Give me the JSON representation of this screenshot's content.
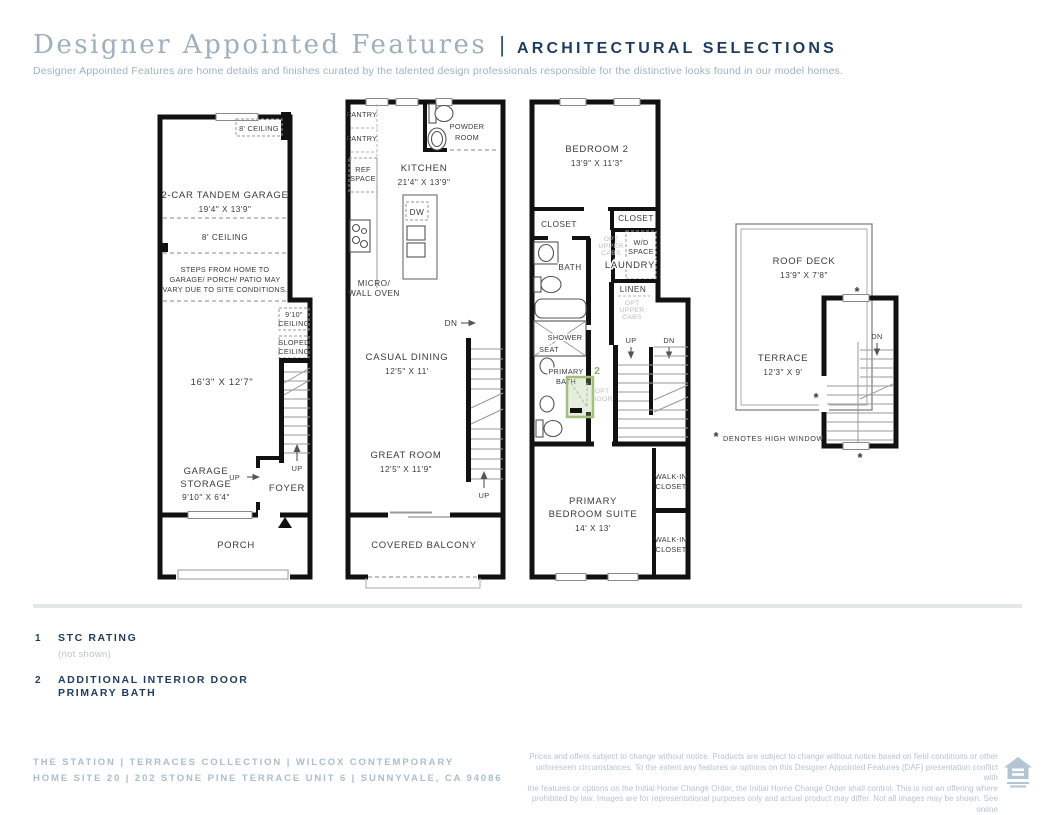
{
  "header": {
    "title_serif": "Designer Appointed Features",
    "divider": "|",
    "title_caps": "ARCHITECTURAL SELECTIONS",
    "subtitle": "Designer Appointed Features are home details and finishes curated by the talented design professionals responsible for the distinctive looks found in our model homes."
  },
  "floor1": {
    "ceiling_note_top": "8' CEILING",
    "garage_name": "2-CAR TANDEM GARAGE",
    "garage_dims": "19'4\" X 13'9\"",
    "ceiling_note_mid": "8' CEILING",
    "steps_note_1": "STEPS FROM HOME TO",
    "steps_note_2": "GARAGE/ PORCH/ PATIO MAY",
    "steps_note_3": "VARY DUE TO SITE CONDITIONS.",
    "ceiling_910_1": "9'10\"",
    "ceiling_910_2": "CEILING",
    "sloped_1": "SLOPED",
    "sloped_2": "CEILING",
    "room_dims": "16'3\" X 12'7\"",
    "storage_1": "GARAGE",
    "storage_2": "STORAGE",
    "storage_dims": "9'10\" X 6'4\"",
    "up_stairs": "UP",
    "up_foyer": "UP",
    "foyer": "FOYER",
    "porch": "PORCH"
  },
  "floor2": {
    "pantry_1": "PANTRY",
    "pantry_2": "PANTRY",
    "ref_1": "REF",
    "ref_2": "SPACE",
    "kitchen": "KITCHEN",
    "kitchen_dims": "21'4\" X 13'9\"",
    "powder_1": "POWDER",
    "powder_2": "ROOM",
    "dw": "DW",
    "micro_1": "MICRO/",
    "micro_2": "WALL OVEN",
    "dn": "DN",
    "casual": "CASUAL DINING",
    "casual_dims": "12'5\" X 11'",
    "great": "GREAT ROOM",
    "great_dims": "12'5\" X 11'9\"",
    "up": "UP",
    "balcony": "COVERED BALCONY"
  },
  "floor3": {
    "bedroom": "BEDROOM 2",
    "bedroom_dims": "13'9\" X 11'3\"",
    "closet_left": "CLOSET",
    "closet_right": "CLOSET",
    "opt_cabs_top": [
      "OPT",
      "UPPER",
      "CABS"
    ],
    "wd_1": "W/D",
    "wd_2": "SPACE",
    "laundry": "LAUNDRY",
    "linen": "LINEN",
    "opt_cabs_bottom": [
      "OPT",
      "UPPER",
      "CABS"
    ],
    "bath": "BATH",
    "shower": "SHOWER",
    "seat": "SEAT",
    "primary_1": "PRIMARY",
    "primary_2": "BATH",
    "callout_2": "2",
    "opt_door_1": "OPT",
    "opt_door_2": "DOOR",
    "up": "UP",
    "dn": "DN",
    "walkin_a1": "WALK-IN",
    "walkin_a2": "CLOSET",
    "walkin_b1": "WALK-IN",
    "walkin_b2": "CLOSET",
    "suite_1": "PRIMARY",
    "suite_2": "BEDROOM SUITE",
    "suite_dims": "14' X 13'"
  },
  "floor4": {
    "roof_deck": "ROOF DECK",
    "roof_dims": "13'9\" X 7'8\"",
    "terrace": "TERRACE",
    "terrace_dims": "12'3\" X 9'",
    "dn": "DN",
    "star": "*",
    "note_star": "*",
    "high_window_note": "DENOTES HIGH WINDOW"
  },
  "legend": {
    "items": [
      {
        "num": "1",
        "label": "STC RATING",
        "sub": "(not shown)"
      },
      {
        "num": "2",
        "label_1": "ADDITIONAL INTERIOR DOOR",
        "label_2": "PRIMARY BATH"
      }
    ]
  },
  "footer": {
    "brand_line1": "THE STATION | TERRACES COLLECTION | WILCOX CONTEMPORARY",
    "brand_line2": "HOME SITE 20 | 202 STONE PINE TERRACE UNIT 6 | SUNNYVALE, CA 94086",
    "disclaimer_lines": [
      "Prices and offers subject to change without notice. Products are subject to change without notice based on field conditions or other",
      "unforeseen circumstances. To the extent any features or options on this Designer Appointed Features (DAF) presentation conflict with",
      "the features or options on the Initial Home Change Order, the Initial Home Change Order shall control. This is not an offering where",
      "prohibited by law. Images are for representational purposes only and actual product may differ. Not all images may be shown. See online",
      "or onsite sales consultants for details."
    ]
  },
  "colors": {
    "accent_navy": "#1d3c5e",
    "muted_blue": "#9fb3c0",
    "plan_ink": "#3b3b3b",
    "optional_gray": "#bdbdbd",
    "highlight_green": "#a3bf7c"
  }
}
